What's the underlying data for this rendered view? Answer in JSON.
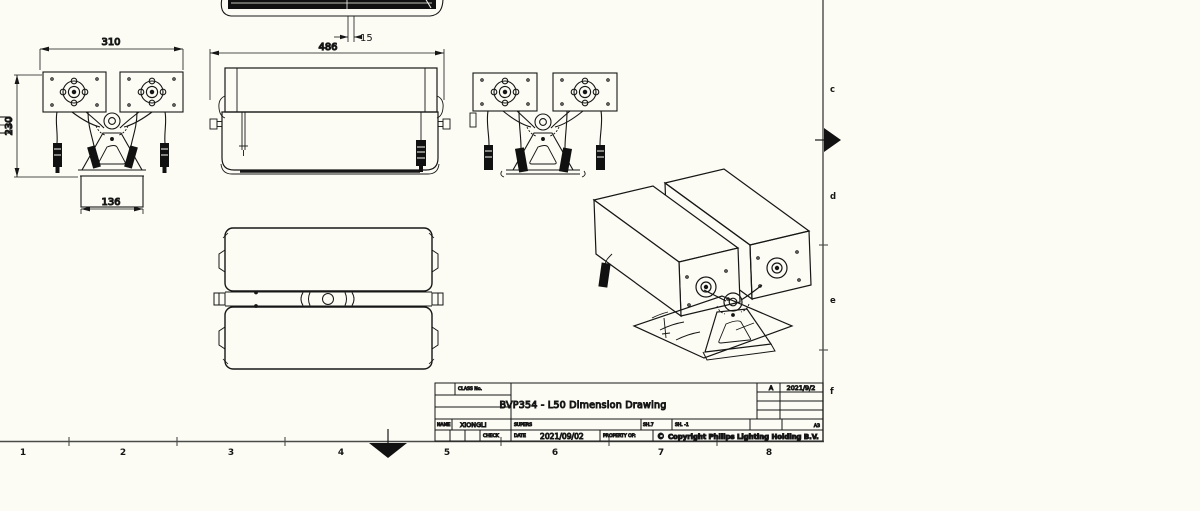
{
  "sheet": {
    "background": "#fcfcf4",
    "frame_color": "#4a4a4a",
    "ink": "#161616"
  },
  "border": {
    "columns": [
      "1",
      "2",
      "3",
      "4",
      "5",
      "6",
      "7",
      "8"
    ],
    "rows": [
      "c",
      "d",
      "e",
      "f"
    ]
  },
  "dimensions": {
    "front_width": "310",
    "front_height": "230",
    "base_width": "136",
    "body_width": "486",
    "lens_offset": "15"
  },
  "title_block": {
    "class_label": "CLASS No.",
    "title": "BVP354 - L50 Dimension Drawing",
    "revision_rev": "A",
    "revision_date": "2021/9/2",
    "name_label": "NAME",
    "name_value": "XIONGLI",
    "supervisor_label": "SUPERS",
    "check_label": "CHECK",
    "date_label": "DATE",
    "date_value": "2021/09/02",
    "property_label": "PROPERTY OF:",
    "copyright_symbol": "©",
    "copyright_text": "Copyright Philips Lighting Holding B.V.",
    "scale_value": "SH.7",
    "sheet_value": "SH. -1",
    "paper_size": "A3"
  }
}
